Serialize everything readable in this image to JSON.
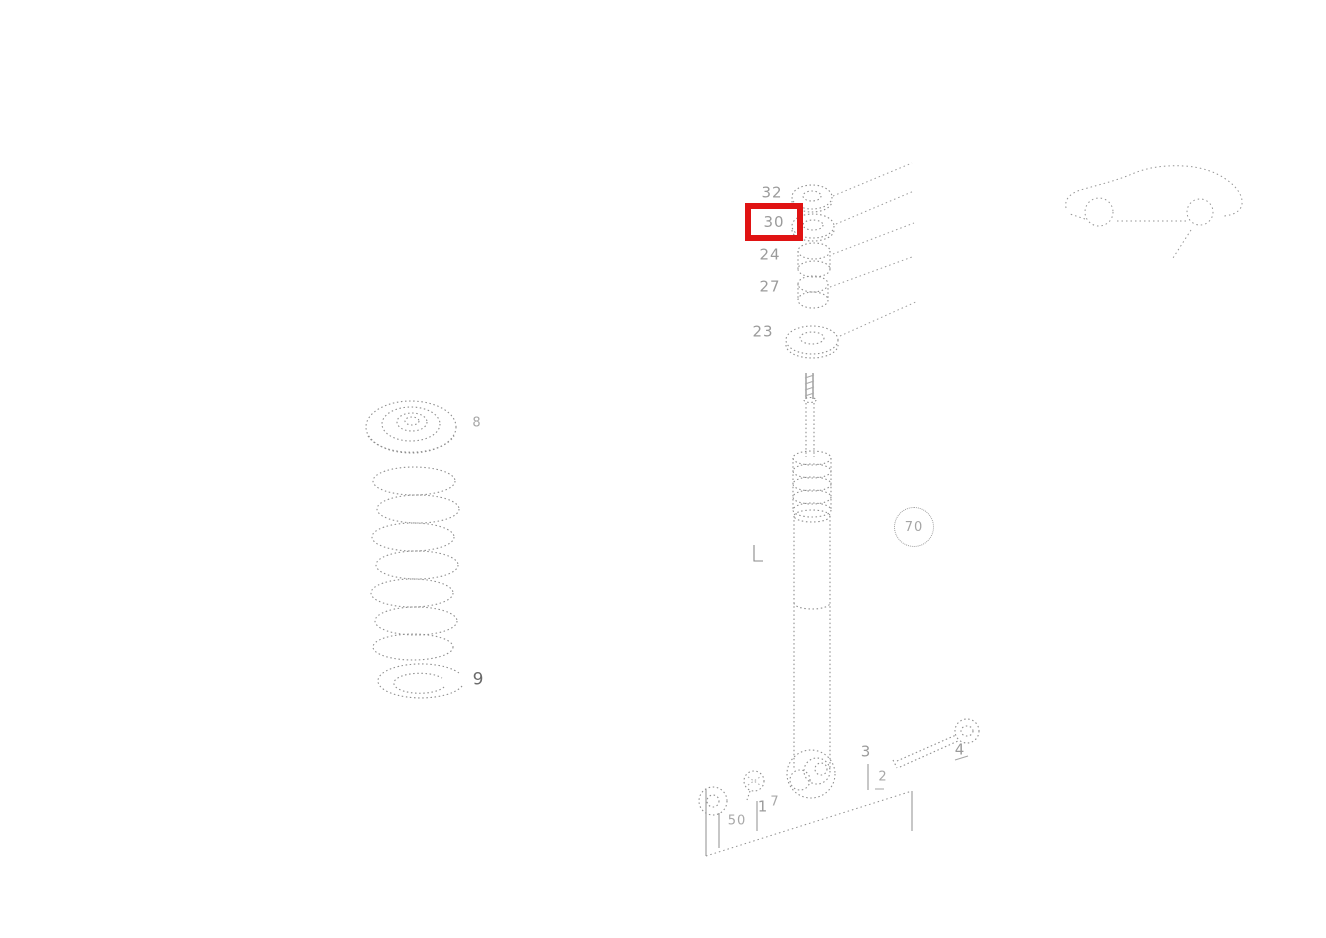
{
  "diagram": {
    "colors": {
      "highlight": "#e01313",
      "lines": "#8e8e8e",
      "labels": "#9b9b9b"
    },
    "highlight": {
      "selected_callout": "30"
    },
    "callouts": {
      "c32": "32",
      "c30": "30",
      "c24": "24",
      "c27": "27",
      "c23": "23",
      "c8": "8",
      "c9": "9",
      "c70": "70",
      "c50": "50",
      "c1": "1",
      "c7": "7",
      "c3": "3",
      "c2": "2",
      "c4": "4"
    }
  }
}
